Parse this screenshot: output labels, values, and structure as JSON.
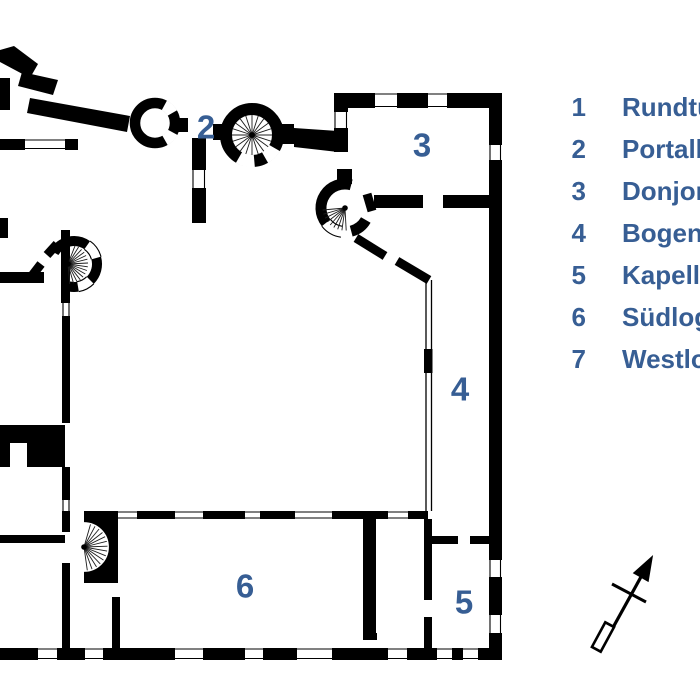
{
  "colors": {
    "wall": "#000000",
    "background": "#ffffff",
    "label_blue": "#375e94"
  },
  "plan": {
    "room_labels": [
      {
        "text": "2"
      },
      {
        "text": "3"
      },
      {
        "text": "4"
      },
      {
        "text": "5"
      },
      {
        "text": "6"
      }
    ]
  },
  "legend": {
    "items": [
      {
        "num": "1",
        "label": "Rundturm"
      },
      {
        "num": "2",
        "label": "Portalbau"
      },
      {
        "num": "3",
        "label": "Donjon"
      },
      {
        "num": "4",
        "label": "Bogengang"
      },
      {
        "num": "5",
        "label": "Kapelle"
      },
      {
        "num": "6",
        "label": "Südloggia"
      },
      {
        "num": "7",
        "label": "Westloggia"
      }
    ]
  },
  "compass": {
    "icon": "north-arrow"
  }
}
